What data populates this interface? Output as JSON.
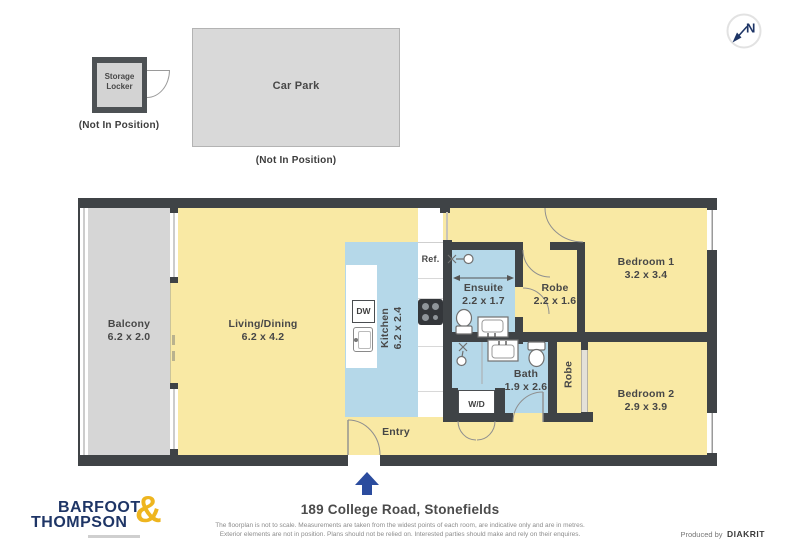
{
  "colors": {
    "wall": "#3F4346",
    "floor_yellow": "#F9E9A4",
    "wet_area_blue": "#B5D8E9",
    "balcony_gray": "#D6D6D6",
    "brand_navy": "#1E3566",
    "brand_gold": "#EEB51F",
    "entry_arrow_blue": "#2B4C9E"
  },
  "annex": {
    "storage_locker": {
      "line1": "Storage",
      "line2": "Locker",
      "note": "(Not In Position)"
    },
    "car_park": {
      "label": "Car Park",
      "note": "(Not In Position)"
    },
    "compass_n": "N"
  },
  "rooms": {
    "balcony": {
      "name": "Balcony",
      "dims": "6.2 x 2.0"
    },
    "living": {
      "name": "Living/Dining",
      "dims": "6.2 x 4.2"
    },
    "kitchen": {
      "name": "Kitchen",
      "dims": "6.2 x 2.4"
    },
    "ensuite": {
      "name": "Ensuite",
      "dims": "2.2 x 1.7"
    },
    "robe1": {
      "name": "Robe",
      "dims": "2.2 x 1.6"
    },
    "bedroom1": {
      "name": "Bedroom 1",
      "dims": "3.2 x 3.4"
    },
    "bath": {
      "name": "Bath",
      "dims": "1.9 x 2.6"
    },
    "robe2": {
      "name": "Robe"
    },
    "bedroom2": {
      "name": "Bedroom 2",
      "dims": "2.9 x 3.9"
    },
    "entry": {
      "name": "Entry"
    }
  },
  "fixtures": {
    "fridge": "Ref.",
    "dishwasher": "DW",
    "washer_dryer": "W/D"
  },
  "footer": {
    "brand_line1": "BARFOOT",
    "brand_line2": "THOMPSON",
    "brand_amp": "&",
    "address": "189 College Road, Stonefields",
    "disclaimer_line1": "The floorplan is not to scale. Measurements are taken from the widest points of each room, are indicative only and are in metres.",
    "disclaimer_line2": "Exterior elements are not in position. Plans should not be relied on. Interested parties should make and rely on their enquires.",
    "produced_by": "Produced by",
    "producer": "DIAKRIT"
  }
}
